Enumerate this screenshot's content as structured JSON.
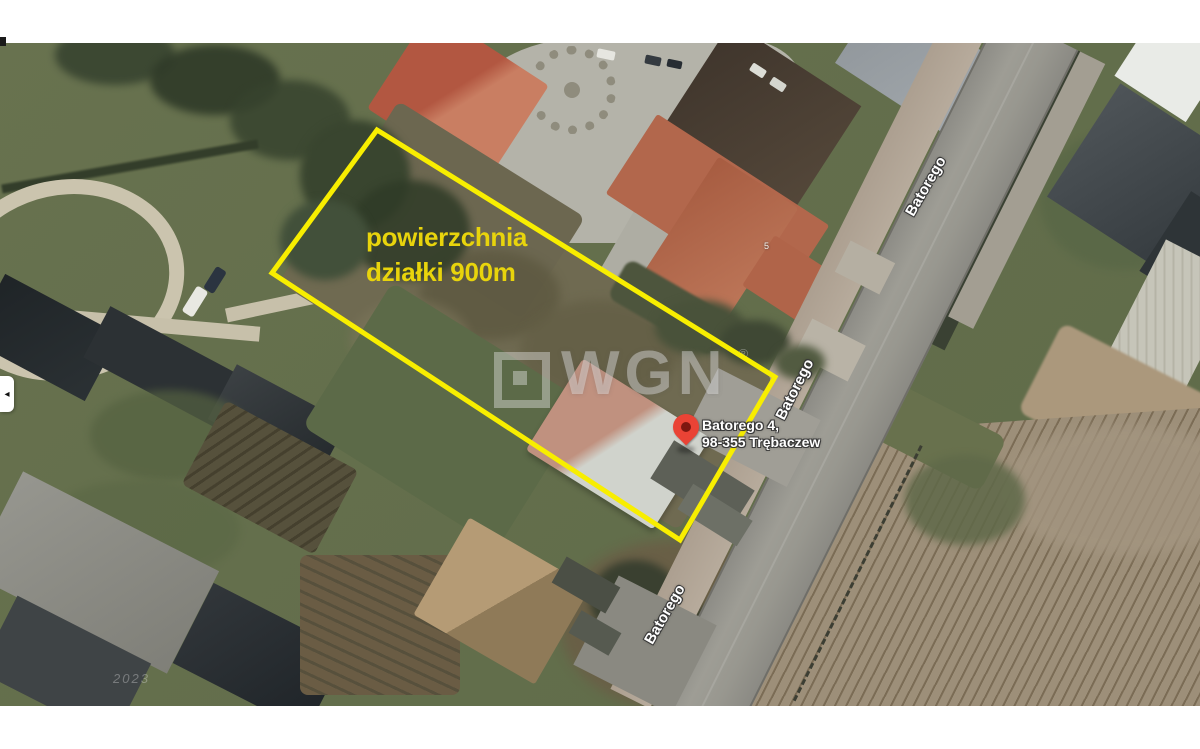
{
  "map": {
    "plot_annotation": {
      "line1": "powierzchnia",
      "line2": "działki 900m",
      "text_color": "#e8d40c"
    },
    "plot_outline": {
      "color": "#f8ee00",
      "corners": [
        [
          377,
          130
        ],
        [
          775,
          377
        ],
        [
          680,
          540
        ],
        [
          272,
          273
        ]
      ]
    },
    "marker": {
      "address_line1": "Batorego 4,",
      "address_line2": "98-355 Trębaczew",
      "pin_color": "#ea4335"
    },
    "street_labels": [
      {
        "name": "Batorego"
      },
      {
        "name": "Batorego"
      },
      {
        "name": "Batorego"
      }
    ],
    "house_number": "5",
    "watermark": {
      "brand": "WGN",
      "registered_mark": "®"
    },
    "imagery_date": "2023",
    "edge_control": {
      "icon": "arrow-left",
      "glyph": "◂"
    }
  }
}
